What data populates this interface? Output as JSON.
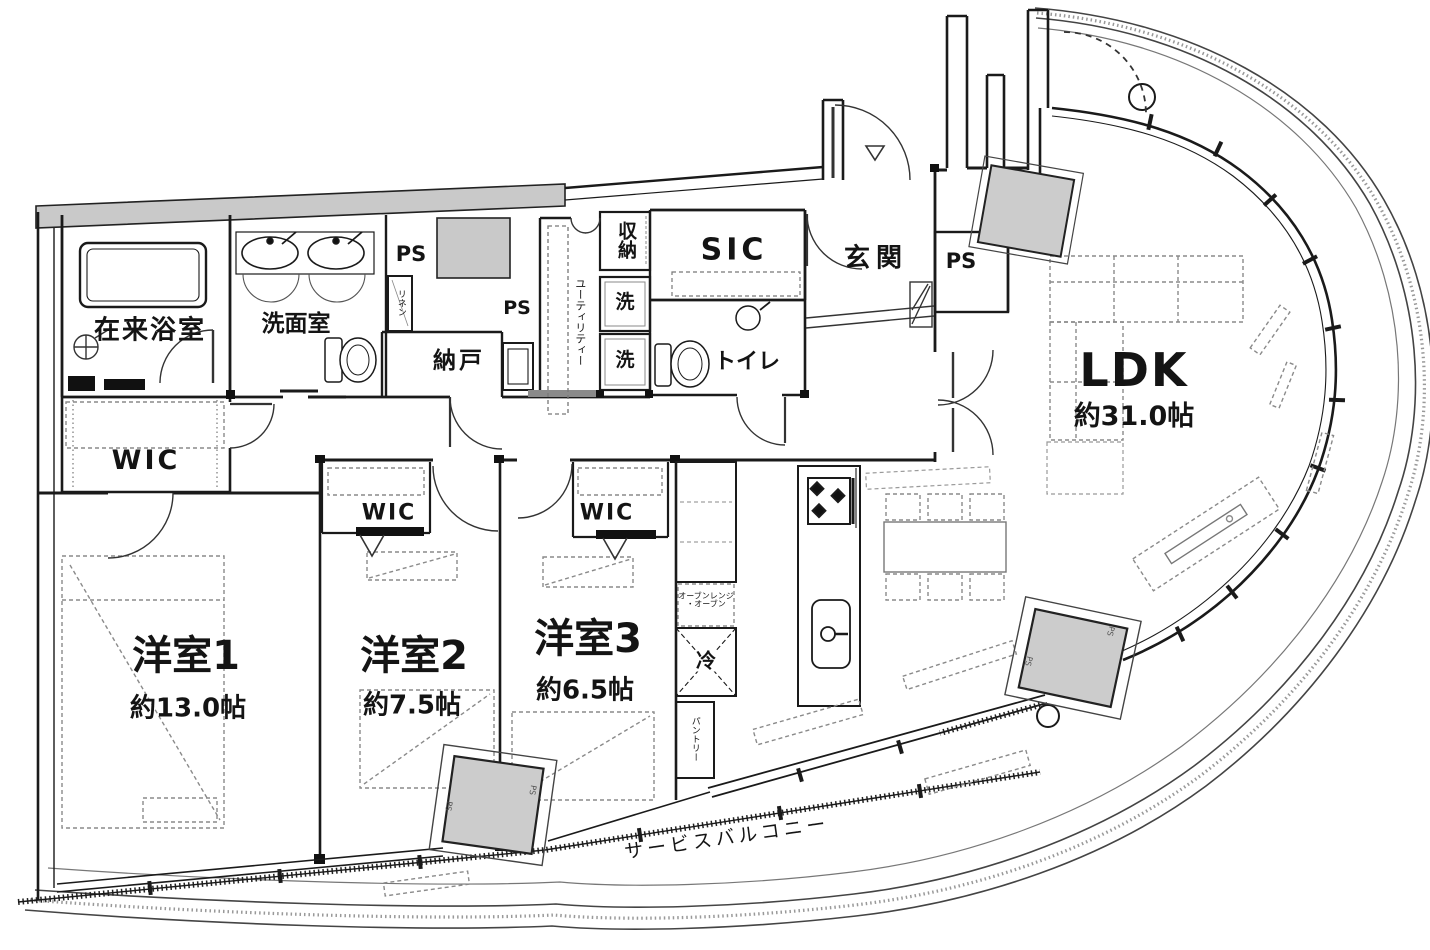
{
  "plan": {
    "type": "apartment-floor-plan",
    "rooms": {
      "ldk": {
        "label": "LDK",
        "size": "約31.0帖"
      },
      "bedroom1": {
        "label": "洋室1",
        "size": "約13.0帖"
      },
      "bedroom2": {
        "label": "洋室2",
        "size": "約7.5帖"
      },
      "bedroom3": {
        "label": "洋室3",
        "size": "約6.5帖"
      },
      "bath": {
        "label": "在来浴室"
      },
      "washroom": {
        "label": "洗面室"
      },
      "storage_room": {
        "label": "納戸"
      },
      "closet": {
        "label": "収納"
      },
      "shoe_closet": {
        "label": "SIC"
      },
      "toilet": {
        "label": "トイレ"
      },
      "entrance": {
        "label": "玄関"
      },
      "wic": {
        "label": "WIC"
      },
      "service_balcony": {
        "label": "サービスバルコニー"
      }
    },
    "fixtures": {
      "pipe_space": {
        "label": "PS"
      },
      "linen": {
        "label": "リネン"
      },
      "utility": {
        "label": "ユーティリティー"
      },
      "washer": {
        "label": "洗"
      },
      "refrigerator": {
        "label": "冷"
      },
      "pantry": {
        "label": "パントリー"
      },
      "oven_range": {
        "label": "オーブンレンジ",
        "label2": "・オーブン"
      }
    },
    "colors": {
      "wall": "#1a1a1a",
      "shaft_fill": "#c9c9c9",
      "furniture": "#8a8a8a",
      "background": "#ffffff"
    }
  }
}
